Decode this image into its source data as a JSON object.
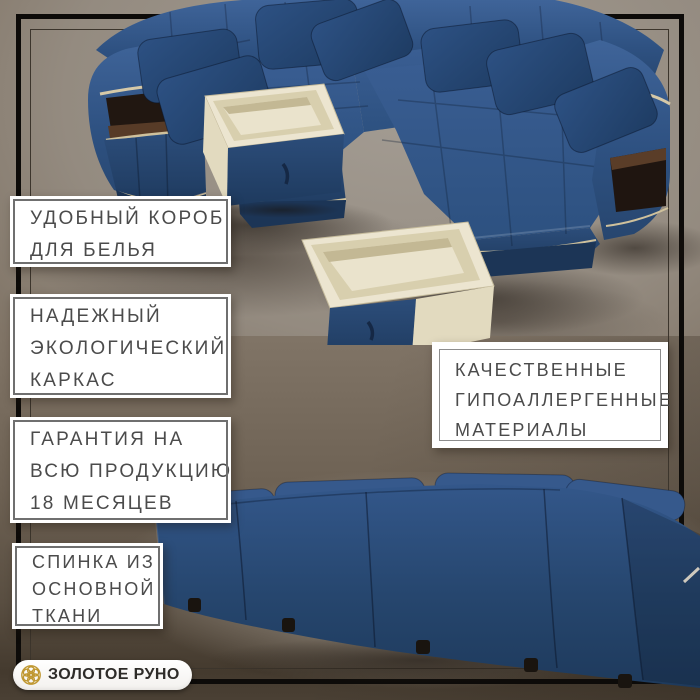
{
  "brand": {
    "name": "ЗОЛОТОЕ РУНО",
    "emblem_icon": "golden-fleece-rosette-icon"
  },
  "features": [
    {
      "id": "linen-storage",
      "lines": [
        "УДОБНЫЙ КОРОБ",
        "ДЛЯ БЕЛЬЯ"
      ]
    },
    {
      "id": "eco-frame",
      "lines": [
        "НАДЕЖНЫЙ",
        "ЭКОЛОГИЧЕСКИЙ",
        "КАРКАС"
      ]
    },
    {
      "id": "warranty",
      "lines": [
        "ГАРАНТИЯ НА",
        "ВСЮ ПРОДУКЦИЮ",
        "18 МЕСЯЦЕВ"
      ]
    },
    {
      "id": "backrest-fabric",
      "lines": [
        "СПИНКА ИЗ",
        "ОСНОВНОЙ",
        "ТКАНИ"
      ]
    },
    {
      "id": "materials",
      "lines": [
        "КАЧЕСТВЕННЫЕ",
        "ГИПОАЛЛЕРГЕННЫЕ",
        "МАТЕРИАЛЫ"
      ]
    }
  ],
  "colors": {
    "sofa_blue": "#31568a",
    "sofa_blue_dark": "#24436b",
    "pillow_navy": "#223f66",
    "drawer_cream": "#ece5d0",
    "trim_cream": "#cfc19c",
    "wood_brown": "#573b27",
    "frame_black": "#0d0b09",
    "inner_frame": "#3c352c",
    "box_border": "#6f6f6f",
    "text_gray": "#4b4b4b",
    "logo_gold": "#bf9730",
    "background_top": "#8d8174",
    "background_bottom": "#443a2e"
  }
}
